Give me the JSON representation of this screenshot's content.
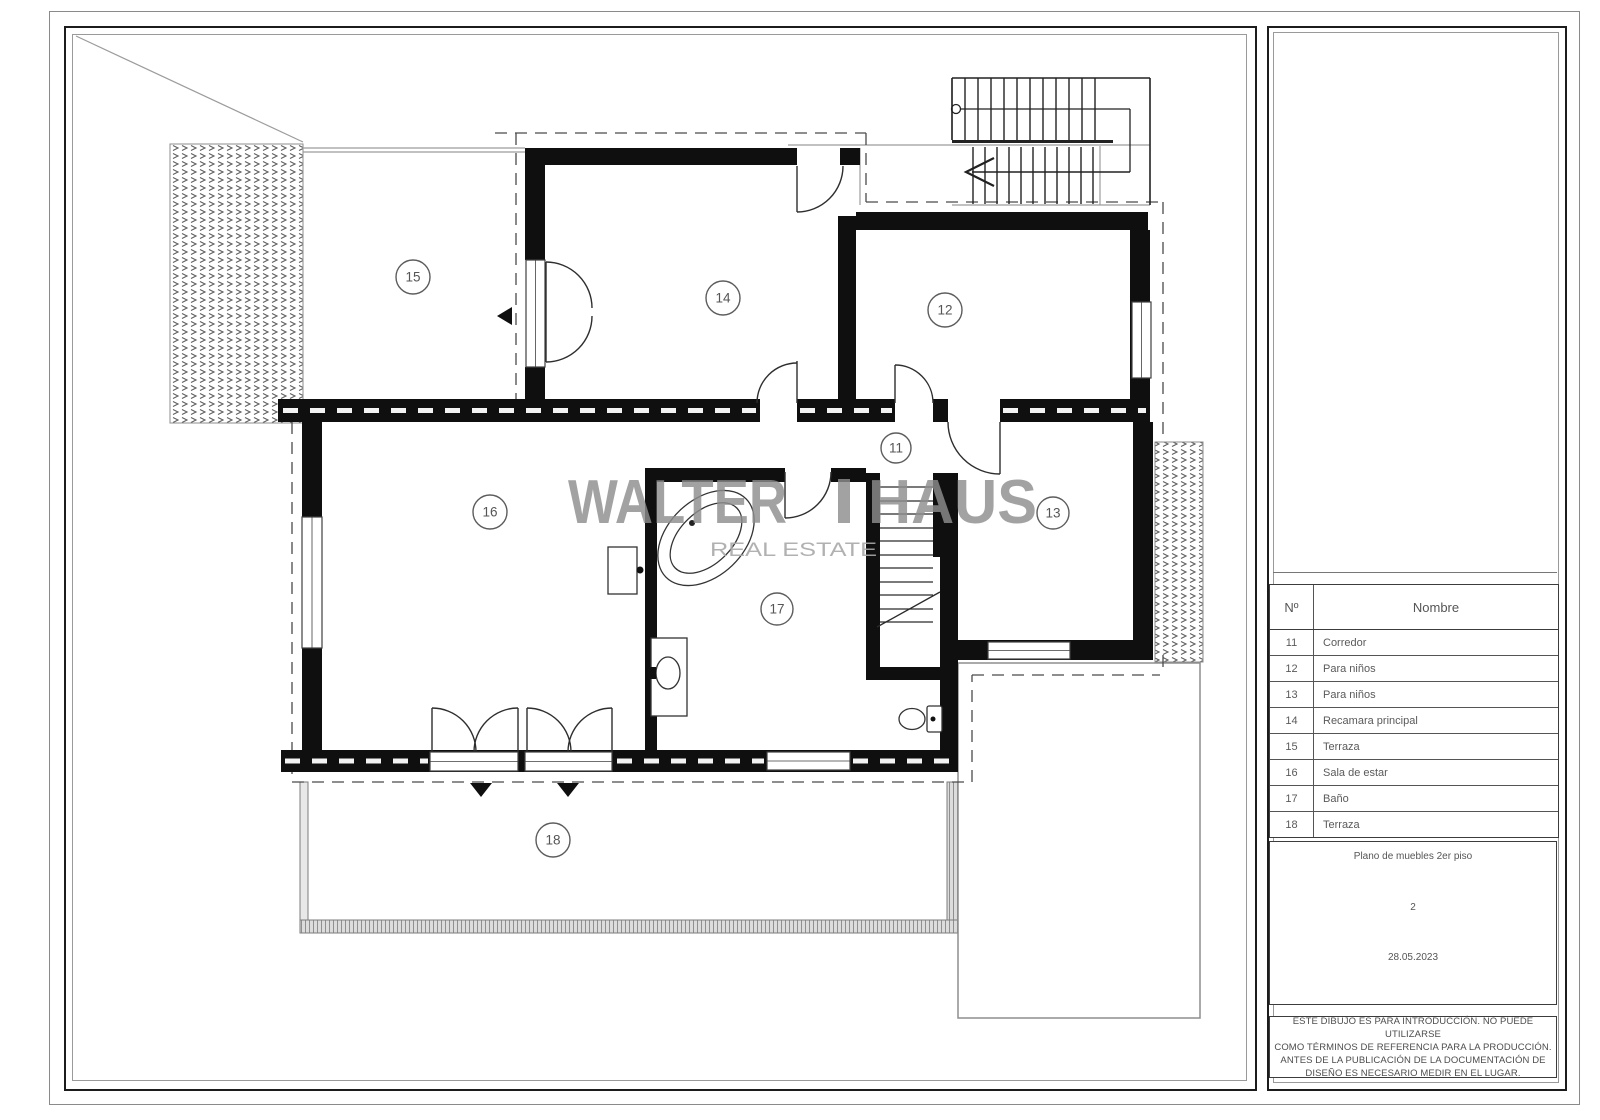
{
  "watermark": {
    "word_left": "WALTER",
    "word_right": "HAUS",
    "subtitle": "REAL ESTATE"
  },
  "plan": {
    "labels": {
      "r11": "11",
      "r12": "12",
      "r13": "13",
      "r14": "14",
      "r15": "15",
      "r16": "16",
      "r17": "17",
      "r18": "18"
    }
  },
  "legend": {
    "header": {
      "no": "Nº",
      "name": "Nombre"
    },
    "rows": [
      {
        "no": "11",
        "name": "Corredor"
      },
      {
        "no": "12",
        "name": "Para niños"
      },
      {
        "no": "13",
        "name": "Para niños"
      },
      {
        "no": "14",
        "name": "Recamara principal"
      },
      {
        "no": "15",
        "name": "Terraza"
      },
      {
        "no": "16",
        "name": "Sala de estar"
      },
      {
        "no": "17",
        "name": "Baño"
      },
      {
        "no": "18",
        "name": "Terraza"
      }
    ]
  },
  "title_block": {
    "drawing_title": "Plano de muebles 2er piso",
    "sheet_number": "2",
    "date": "28.05.2023"
  },
  "disclaimer": {
    "line1": "ESTE DIBUJO ES PARA INTRODUCCIÓN. NO PUEDE UTILIZARSE",
    "line2": "COMO TÉRMINOS DE REFERENCIA PARA LA PRODUCCIÓN.",
    "line3": "ANTES DE LA PUBLICACIÓN DE LA DOCUMENTACIÓN DE",
    "line4": "DISEÑO ES NECESARIO MEDIR EN EL LUGAR."
  }
}
